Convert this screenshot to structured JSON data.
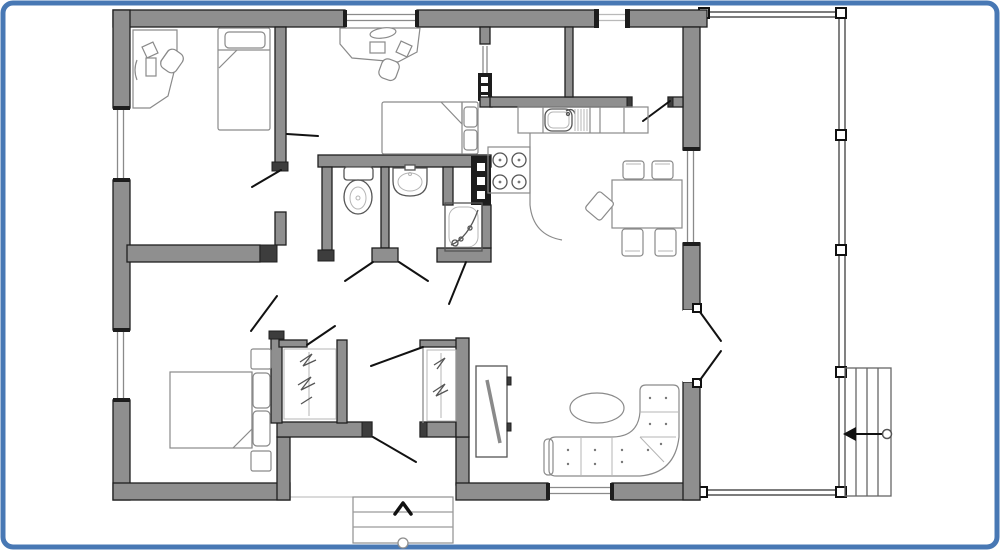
{
  "canvas": {
    "width": 1000,
    "height": 550,
    "background": "#ffffff"
  },
  "palette": {
    "frame_border": "#4878b4",
    "wall_fill": "#8f8f8f",
    "wall_stroke": "#1f1f1f",
    "furniture_stroke": "#8a8a8a",
    "door_leaf": "#121212",
    "terrace_line": "#2e2e2e"
  },
  "plan": {
    "type": "single-storey-house-floor-plan",
    "rooms": [
      {
        "name": "bedroom-office-top-left",
        "furniture": [
          "corner-desk",
          "desk-chair",
          "single-bed"
        ]
      },
      {
        "name": "bedroom-middle",
        "furniture": [
          "desk",
          "desk-chair",
          "single-bed"
        ]
      },
      {
        "name": "pantry-room"
      },
      {
        "name": "back-entry-room"
      },
      {
        "name": "wc-room",
        "furniture": [
          "toilet"
        ]
      },
      {
        "name": "washroom",
        "furniture": [
          "wash-basin"
        ]
      },
      {
        "name": "shower-room",
        "furniture": [
          "corner-shower"
        ]
      },
      {
        "name": "kitchen",
        "furniture": [
          "kitchen-sink",
          "drainer",
          "stove-4-burners",
          "counter",
          "flue-block"
        ]
      },
      {
        "name": "dining-area",
        "furniture": [
          "dining-table",
          "chair",
          "chair",
          "chair",
          "chair",
          "chair"
        ]
      },
      {
        "name": "living-room",
        "furniture": [
          "corner-sofa",
          "oval-coffee-table",
          "tv-cabinet"
        ]
      },
      {
        "name": "master-bedroom",
        "furniture": [
          "double-bed",
          "nightstand",
          "nightstand"
        ]
      },
      {
        "name": "wardrobe-closet-1",
        "furniture": [
          "clothes-rail"
        ]
      },
      {
        "name": "wardrobe-closet-2",
        "furniture": [
          "clothes-rail"
        ]
      },
      {
        "name": "entry-hall"
      },
      {
        "name": "terrace",
        "features": [
          "posts",
          "side-stairs"
        ]
      },
      {
        "name": "front-porch",
        "features": [
          "steps",
          "entrance-arrow"
        ]
      }
    ],
    "windows": 5,
    "exterior_doors": [
      "back-door-top",
      "front-door-bottom",
      "french-doors-to-terrace"
    ],
    "icons": [
      "entrance-chevron-icon",
      "stairs-direction-arrow-icon"
    ]
  }
}
